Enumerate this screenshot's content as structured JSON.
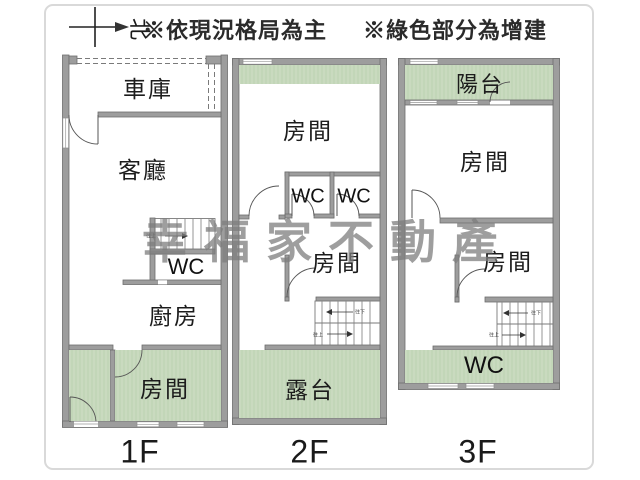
{
  "header": {
    "note_layout": "※依現況格局為主",
    "note_addition": "※綠色部分為增建",
    "compass_north": "北"
  },
  "watermark": "幸福家不動產",
  "colors": {
    "addition_green": "#c9dabf",
    "wall_gray": "#9d9d9d",
    "wall_outline": "#6e6e6e"
  },
  "floors": {
    "f1": {
      "label": "1F",
      "garage": "車庫",
      "living": "客廳",
      "wc": "WC",
      "kitchen": "廚房",
      "bedroom": "房間",
      "stair_up": "往上"
    },
    "f2": {
      "label": "2F",
      "room_front": "房間",
      "wc_left": "WC",
      "wc_right": "WC",
      "room_mid": "房間",
      "terrace": "露台",
      "stair_up": "往上",
      "stair_down": "往下"
    },
    "f3": {
      "label": "3F",
      "balcony": "陽台",
      "room_front": "房間",
      "room_mid": "房間",
      "wc": "WC",
      "stair_up": "往上",
      "stair_down": "往下"
    }
  }
}
